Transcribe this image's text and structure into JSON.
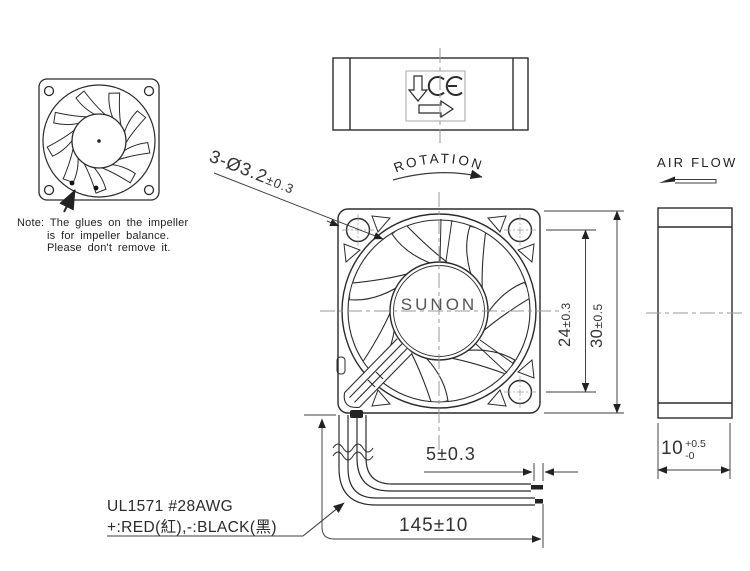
{
  "labels": {
    "rotation": "ROTATION",
    "air_flow": "AIR FLOW",
    "brand": "SUNON",
    "ce_mark": "CE"
  },
  "note": {
    "line1": "Note: The glues on the impeller",
    "line2": "is for impeller balance.",
    "line3": "Please don't remove it."
  },
  "wire_spec": {
    "line1": "UL1571  #28AWG",
    "line2": "+:RED(紅),-:BLACK(黑)"
  },
  "dimensions": {
    "mounting_holes": {
      "value": "3-Ø3.2",
      "tolerance": "±0.3"
    },
    "hole_pitch": {
      "value": "24",
      "tolerance": "±0.3"
    },
    "frame_size": {
      "value": "30",
      "tolerance": "±0.5"
    },
    "lead_tin_length": {
      "value": "5",
      "tolerance": "±0.3"
    },
    "wire_length": {
      "value": "145",
      "tolerance": "±10"
    },
    "frame_depth": {
      "value": "10",
      "tol_plus": "+0.5",
      "tol_minus": "-0"
    }
  },
  "colors": {
    "line": "#2b2b2b",
    "dim_line": "#3c3c3c",
    "centerline": "#9a9a9a",
    "background": "#ffffff",
    "text": "#2f2f2f"
  }
}
